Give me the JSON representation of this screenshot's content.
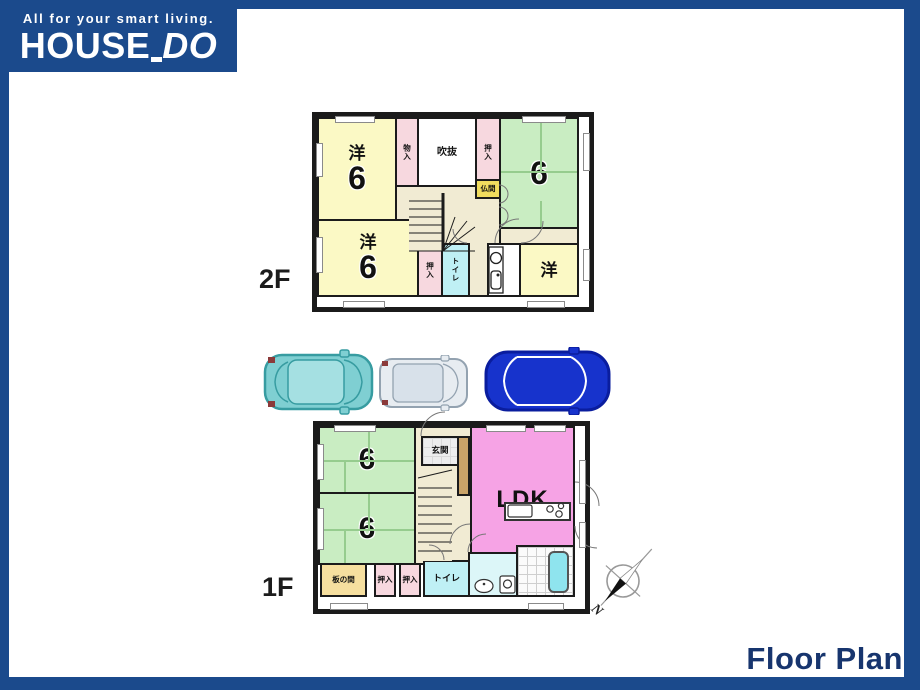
{
  "header": {
    "tagline": "All for your smart living.",
    "brand_house": "HOUSE",
    "brand_do": "DO"
  },
  "footer": {
    "title": "Floor Plan"
  },
  "compass": {
    "north": "N"
  },
  "floor2": {
    "label": "2F",
    "west_top": {
      "kind": "洋",
      "size": "6"
    },
    "west_bottom": {
      "kind": "洋",
      "size": "6"
    },
    "west_right": {
      "kind": "洋"
    },
    "tatami": {
      "size": "6"
    },
    "monoire": "物入",
    "fukinuke": "吹抜",
    "oshiire_top": "押入",
    "butsuma": "仏間",
    "oshiire_bottom": "押入",
    "toilet": "トイレ"
  },
  "floor1": {
    "label": "1F",
    "tatami_top": {
      "size": "6"
    },
    "tatami_bottom": {
      "size": "6"
    },
    "entrance": "玄関",
    "ldk": "LDK",
    "itanoma": "板の間",
    "oshiire_a": "押入",
    "oshiire_b": "押入",
    "toilet": "トイレ"
  },
  "cars": [
    {
      "name": "teal-hatchback"
    },
    {
      "name": "gray-compact"
    },
    {
      "name": "blue-sedan"
    }
  ],
  "colors": {
    "frame": "#1B4A8C",
    "title": "#17356E",
    "wall": "#1b1b1b",
    "yellow": "#FBF9C5",
    "green": "#C9EDC2",
    "pink": "#F7D8DF",
    "cyan": "#BFF0F5",
    "washcyan": "#DCF6F8",
    "ldk": "#F6A3E5",
    "beige": "#F1EBD3",
    "tan": "#C9A368",
    "itanoma": "#F6DF9F",
    "butsuma": "#F0DC5E",
    "bath": "#8FE4EE",
    "car_teal": "#7FCFD2",
    "car_teal_dark": "#379CA1",
    "car_teal_roof": "#A5E0E2",
    "car_gray": "#E7ECF1",
    "car_gray_dark": "#93A2B0",
    "car_gray_roof": "#D8E1EA",
    "car_blue": "#1733CC",
    "car_blue_dark": "#0A1D9E"
  }
}
